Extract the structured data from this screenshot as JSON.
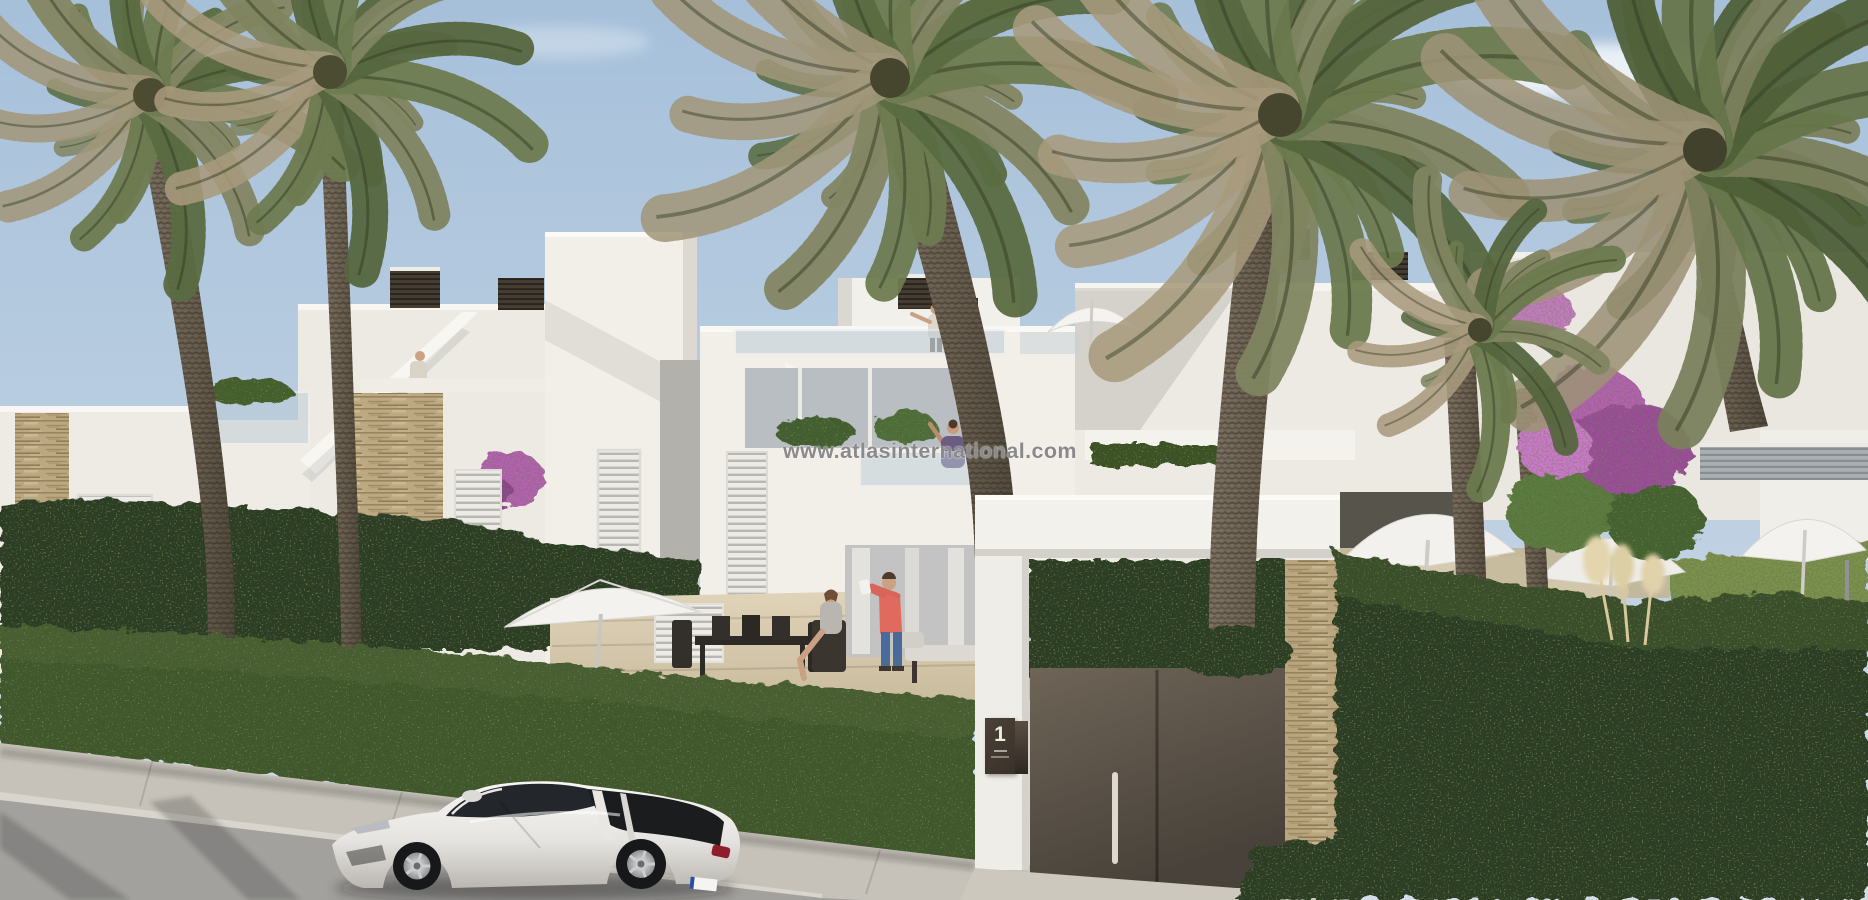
{
  "watermark": {
    "text": "www.atlasinternational.com"
  },
  "entrance": {
    "number": "1"
  },
  "palette": {
    "sky_top": "#a6c0da",
    "sky_mid": "#bccfe1",
    "sky_bottom": "#d3dde7",
    "wall_sunlit": "#f2efe9",
    "wall_light": "#eceae3",
    "wall_shade": "#d9d6d0",
    "stone": "#c3ad85",
    "hedge_dark": "#2f3d26",
    "hedge_mid": "#43582e",
    "hedge_light": "#516637",
    "lawn": "#7d9150",
    "road": "#a2a19e",
    "sidewalk": "#c6c2b9",
    "deck": "#d9cdb2",
    "car_body": "#eeede9",
    "car_glass": "#23272b",
    "tail_light": "#b22433",
    "palm_green": "#66764a",
    "palm_dead": "#a1977a",
    "trunk": "#6b6052",
    "gate_door": "#5e574c",
    "plaque": "#4a4036",
    "watermark_gray": "#8a8a8a",
    "coral_shirt": "#e06a5e",
    "jeans": "#4a6b99",
    "bougainvillea": "#b464ae",
    "glass_rail": "#bcccd6"
  }
}
